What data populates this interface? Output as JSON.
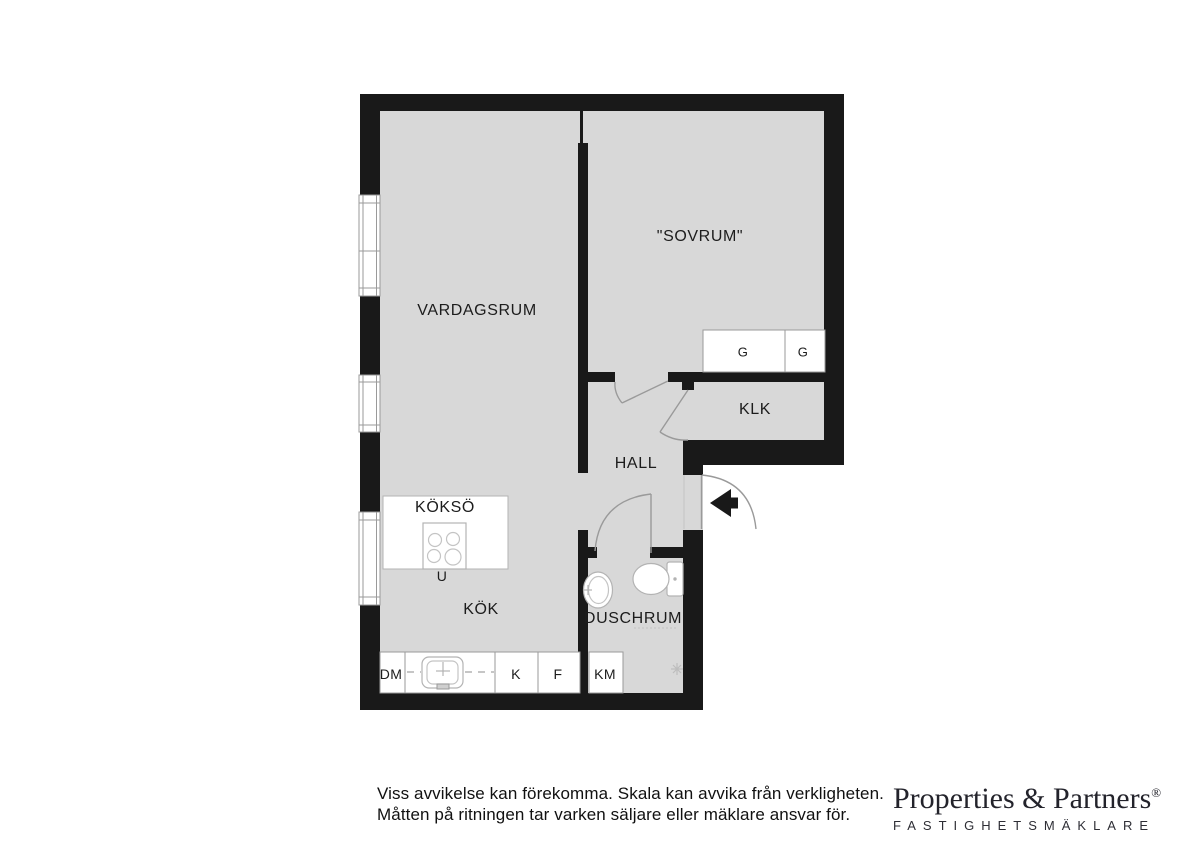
{
  "plan": {
    "rooms": {
      "vardagsrum": "VARDAGSRUM",
      "sovrum": "\"SOVRUM\"",
      "klk": "KLK",
      "hall": "HALL",
      "kokso": "KÖKSÖ",
      "kok": "KÖK",
      "duschrum": "DUSCHRUM"
    },
    "fixtures": {
      "u": "U",
      "dm": "DM",
      "k": "K",
      "f": "F",
      "km": "KM",
      "g1": "G",
      "g2": "G"
    }
  },
  "footer": {
    "disclaimer_line1": "Viss avvikelse kan förekomma. Skala kan avvika från verkligheten.",
    "disclaimer_line2": "Måtten på ritningen tar varken säljare eller mäklare ansvar för.",
    "logo_name": "Properties & Partners",
    "logo_reg": "®",
    "logo_tagline": "FASTIGHETSMÄKLARE"
  },
  "colors": {
    "wall": "#191919",
    "floor": "#d8d8d8",
    "door_line": "#9a9a9a",
    "fixture_line": "#b3b3b3"
  }
}
